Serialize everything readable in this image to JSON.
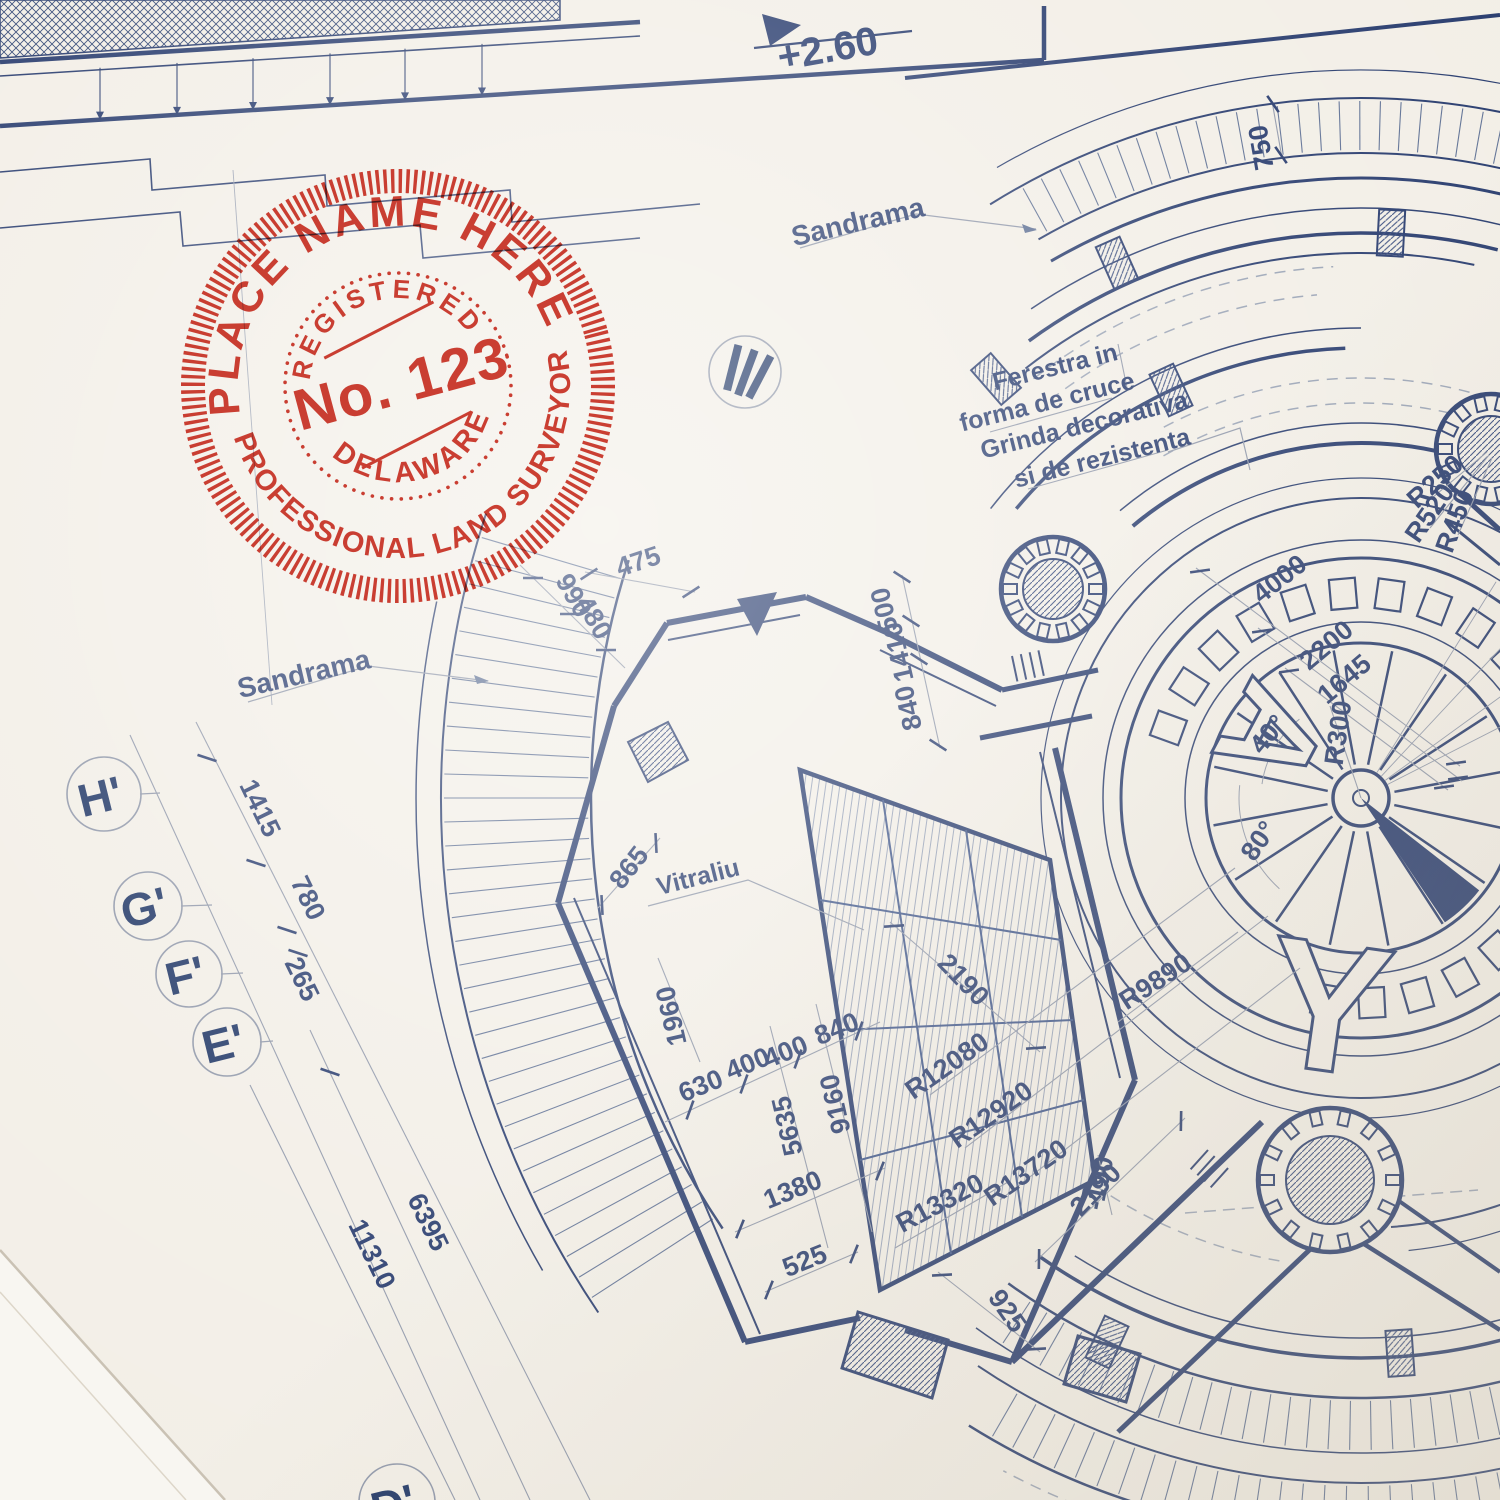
{
  "colors": {
    "paper": "#f2eee6",
    "ink": "#24386b",
    "ink_soft": "#5c6e92",
    "dim_line": "#8e96a8",
    "stamp_red": "#cf392c"
  },
  "stamp": {
    "top_text": "PLACE NAME HERE",
    "registered": "REGISTERED",
    "number": "No. 123",
    "state": "DELAWARE",
    "bottom_text": "PROFESSIONAL LAND SURVEYOR"
  },
  "level_marker": {
    "value": "+2.60"
  },
  "section_marker": {
    "value": "III"
  },
  "labels": {
    "sandrama_top": "Sandrama",
    "sandrama_left": "Sandrama",
    "ferestra_1": "Ferestra in",
    "ferestra_2": "forma de cruce",
    "grinda_1": "Grinda decorativa",
    "grinda_2": "si de rezistenta",
    "vitraliu": "Vitraliu"
  },
  "floor_letters": {
    "a": "A",
    "y": "Y"
  },
  "axis_markers": {
    "h": "H'",
    "g": "G'",
    "f": "F'",
    "e": "E'",
    "d": "D'"
  },
  "dims": {
    "d1415": "1415",
    "d780": "780",
    "d265": "265",
    "d6395": "6395",
    "d11310": "11310",
    "d475": "475",
    "d990": "990",
    "d480": "480",
    "d500": "500",
    "d1410": "1410",
    "d840_top": "840",
    "d865": "865",
    "d1960": "1960",
    "d630": "630",
    "d400_a": "400",
    "d400_b": "400",
    "d840_mid": "840",
    "d5635": "5635",
    "d9160": "9160",
    "d1380": "1380",
    "d525": "525",
    "d925": "925",
    "d2190_a": "2190",
    "d2190_b": "2190",
    "d750": "750",
    "d190": "-190",
    "d4000": "4000",
    "d2200": "2200",
    "d1645": "1645",
    "a40": "40°",
    "a80": "80°"
  },
  "radii": {
    "r300": "R300",
    "r250": "R250",
    "r520": "R520",
    "r450": "R450",
    "r9890": "R9890",
    "r12080": "R12080",
    "r12920": "R12920",
    "r13720": "R13720",
    "r13320": "R13320"
  }
}
